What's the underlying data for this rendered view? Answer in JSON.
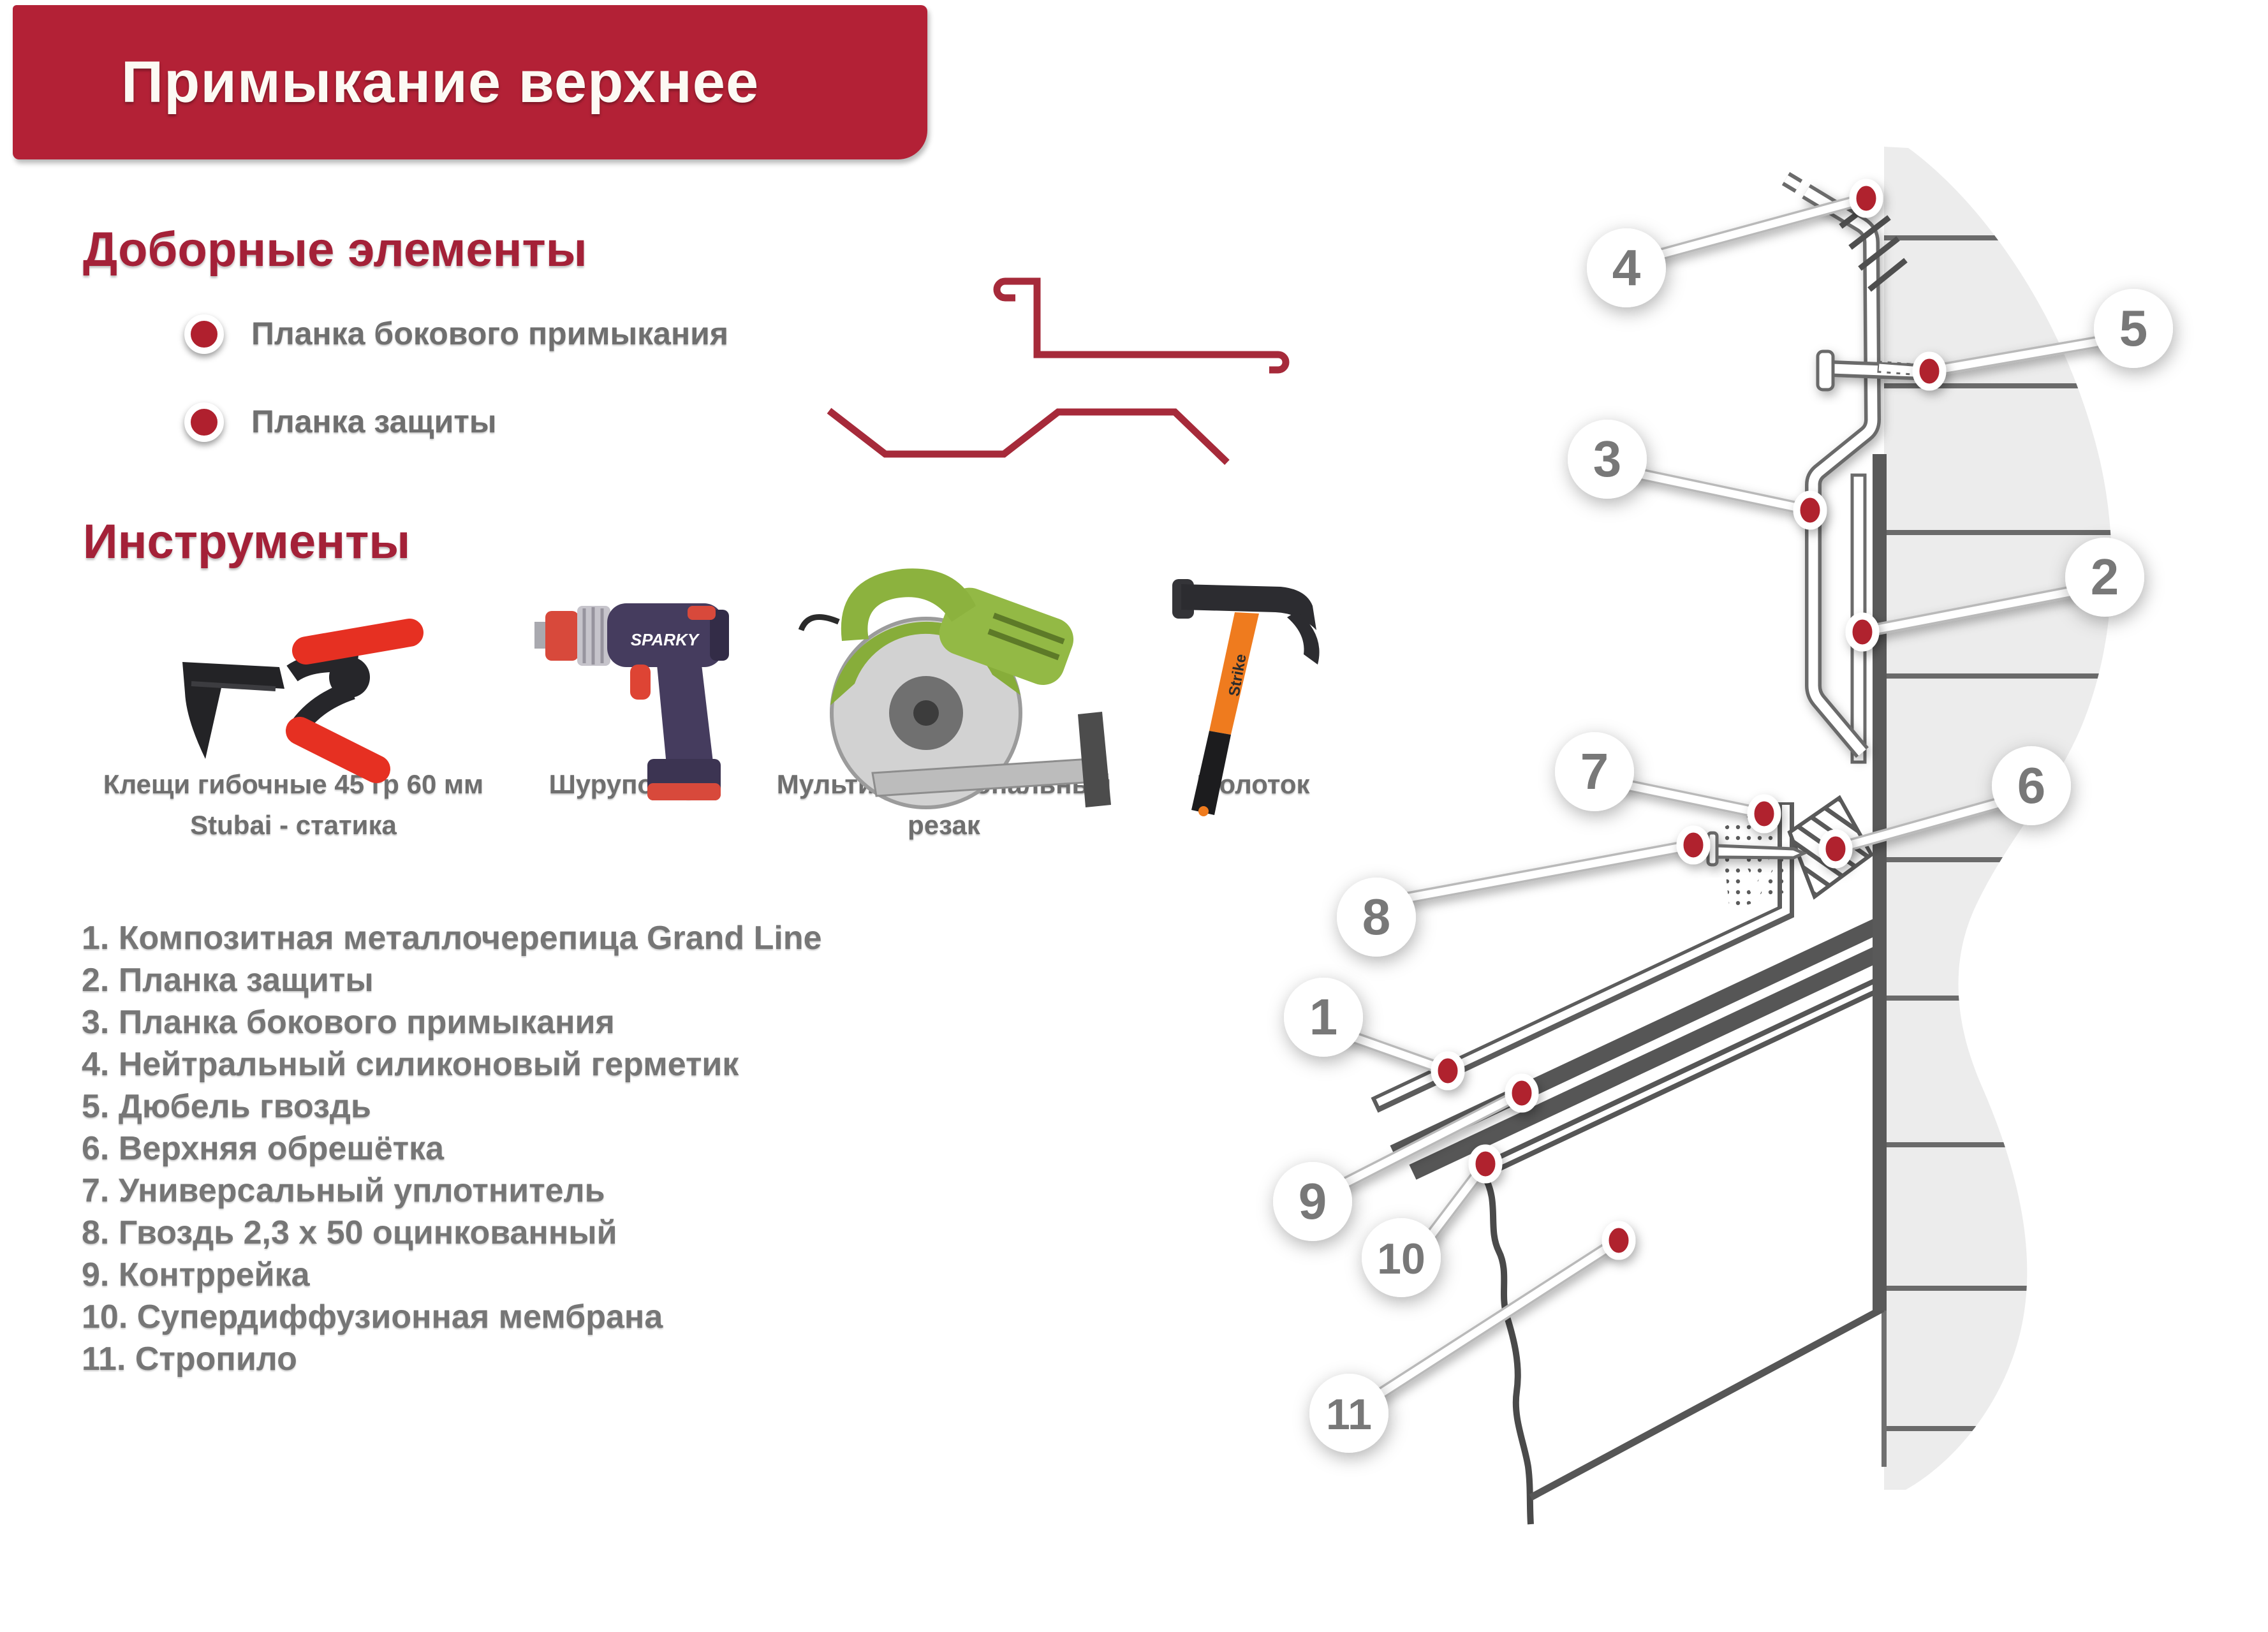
{
  "banner": {
    "title": "Примыкание верхнее"
  },
  "elements_section": {
    "heading": "Доборные элементы",
    "items": [
      {
        "label": "Планка бокового примыкания",
        "profile": "side-abutment-strip-profile"
      },
      {
        "label": "Планка защиты",
        "profile": "protection-strip-profile"
      }
    ]
  },
  "tools_section": {
    "heading": "Инструменты",
    "tools": [
      {
        "icon": "bending-pliers-icon",
        "caption_lines": [
          "Клещи гибочные 45 гр 60 мм",
          "Stubai - статика"
        ]
      },
      {
        "icon": "cordless-drill-icon",
        "brand": "SPARKY",
        "caption_lines": [
          "Шуруповерт"
        ]
      },
      {
        "icon": "circular-saw-icon",
        "caption_lines": [
          "Мультифункциональный",
          "резак"
        ]
      },
      {
        "icon": "hammer-icon",
        "brand": "Strike",
        "caption_lines": [
          "Молоток"
        ]
      }
    ]
  },
  "legend": {
    "items": [
      "1. Композитная металлочерепица Grand Line",
      "2. Планка защиты",
      "3. Планка бокового примыкания",
      "4. Нейтральный силиконовый герметик",
      "5. Дюбель гвоздь",
      "6. Верхняя обрешётка",
      "7. Универсальный уплотнитель",
      "8. Гвоздь 2,3 х 50 оцинкованный",
      "9. Контррейка",
      "10. Супердиффузионная мембрана",
      "11. Стропило"
    ]
  },
  "diagram": {
    "callouts": [
      "1",
      "2",
      "3",
      "4",
      "5",
      "6",
      "7",
      "8",
      "9",
      "10",
      "11"
    ]
  },
  "colors": {
    "banner_red": "#b32136",
    "heading_red": "#a42138",
    "marker_red": "#b0202e",
    "profile_red": "#a62a3a",
    "text_gray": "#767676",
    "wall_gray": "#ececec",
    "line_gray": "#5a5a5a"
  }
}
